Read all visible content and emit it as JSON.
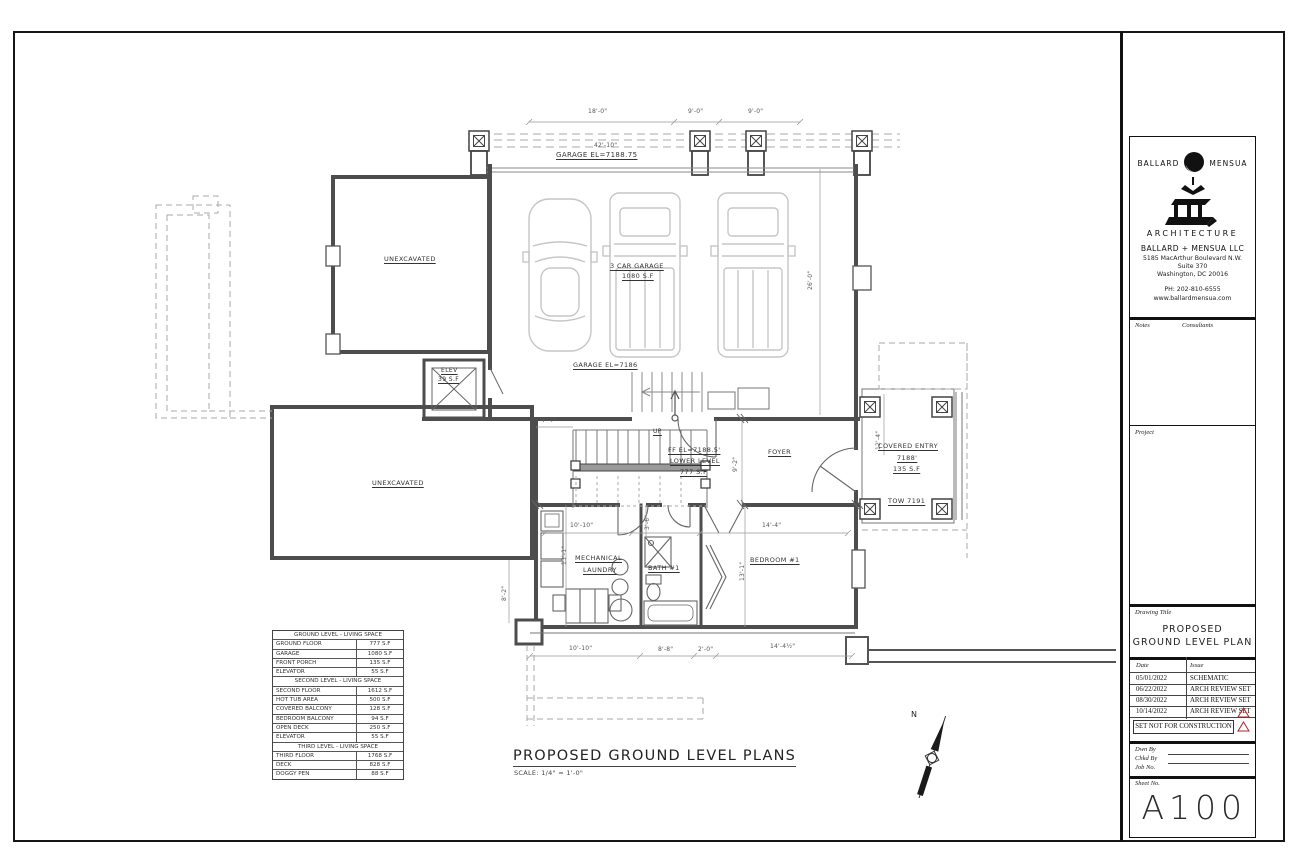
{
  "colors": {
    "wall_line": "#4d4d4d",
    "accent_red": "#b22222"
  },
  "title_block": {
    "logo_left": "BALLARD",
    "logo_right": "MENSUA",
    "logo_subtitle": "ARCHITECTURE",
    "firm_name": "BALLARD + MENSUA LLC",
    "address_line1": "5185 MacArthur Boulevard N.W.",
    "address_line2": "Suite 370",
    "address_line3": "Washington, DC 20016",
    "phone": "PH: 202-810-6555",
    "website": "www.ballardmensua.com",
    "notes_label": "Notes",
    "consultants_label": "Consultants",
    "project_label": "Project",
    "drawing_title_label": "Drawing Title",
    "drawing_title_line1": "PROPOSED",
    "drawing_title_line2": "GROUND LEVEL PLAN",
    "date_header": "Date",
    "issue_header": "Issue",
    "revisions": [
      {
        "date": "05/01/2022",
        "issue": "SCHEMATIC"
      },
      {
        "date": "06/22/2022",
        "issue": "ARCH REVIEW SET"
      },
      {
        "date": "08/30/2022",
        "issue": "ARCH REVIEW SET"
      },
      {
        "date": "10/14/2022",
        "issue": "ARCH REVIEW SET"
      }
    ],
    "not_for_construction": "SET NOT FOR CONSTRUCTION",
    "drawn_by_label": "Dwn By",
    "checked_by_label": "Chkd By",
    "job_no_label": "Job No.",
    "sheet_no_label": "Sheet No.",
    "sheet_number": "A100"
  },
  "area_table": {
    "sections": [
      {
        "header": "GROUND LEVEL - LIVING SPACE",
        "rows": [
          [
            "GROUND FLOOR",
            "777 S.F"
          ],
          [
            "GARAGE",
            "1080 S.F"
          ],
          [
            "FRONT PORCH",
            "135 S.F"
          ],
          [
            "ELEVATOR",
            "55 S.F"
          ]
        ]
      },
      {
        "header": "SECOND LEVEL - LIVING SPACE",
        "rows": [
          [
            "SECOND FLOOR",
            "1612 S.F"
          ],
          [
            "HOT TUB AREA",
            "500 S.F"
          ],
          [
            "COVERED BALCONY",
            "128 S.F"
          ],
          [
            "BEDROOM BALCONY",
            "94 S.F"
          ],
          [
            "OPEN DECK",
            "250 S.F"
          ],
          [
            "ELEVATOR",
            "55 S.F"
          ]
        ]
      },
      {
        "header": "THIRD LEVEL - LIVING SPACE",
        "rows": [
          [
            "THIRD FLOOR",
            "1768 S.F"
          ],
          [
            "DECK",
            "828 S.F"
          ],
          [
            "DOGGY PEN",
            "88 S.F"
          ]
        ]
      }
    ]
  },
  "plan": {
    "title": "PROPOSED GROUND LEVEL PLANS",
    "scale": "SCALE: 1/4\" = 1'-0\"",
    "north_label": "N",
    "labels": {
      "dim_18_0": "18'-0\"",
      "dim_9_0_a": "9'-0\"",
      "dim_9_0_b": "9'-0\"",
      "dim_42_10": "42'-10\"",
      "garage_el_upper": "GARAGE EL=7188.75",
      "unexcavated_upper": "UNEXCAVATED",
      "unexcavated_lower": "UNEXCAVATED",
      "garage_name": "3 CAR GARAGE",
      "garage_area": "1080 S.F",
      "garage_el_mid": "GARAGE EL=7186",
      "elev_name": "ELEV",
      "elev_area": "39 S.F",
      "up_label": "UP",
      "ff_el": "FF EL=7188.5'",
      "lower_level": "LOWER LEVEL",
      "lower_area": "777 S.F",
      "foyer": "FOYER",
      "covered_entry": "COVERED ENTRY",
      "entry_el": "7188'",
      "entry_area": "135 S.F",
      "tow": "TOW 7191",
      "mech_line1": "MECHANICAL",
      "mech_line2": "LAUNDRY",
      "bath": "BATH #1",
      "bedroom": "BEDROOM #1",
      "dim_10_10_top": "10'-10\"",
      "dim_14_4": "14'-4\"",
      "dim_10_10_bot": "10'-10\"",
      "dim_8_8": "8'-8\"",
      "dim_2_0": "2'-0\"",
      "dim_14_4_half": "14'-4½\"",
      "dim_8_2": "8'-2\"",
      "dim_9_2": "9'-2\"",
      "dim_12_4": "12'-4\"",
      "dim_13_1_a": "13'-1\"",
      "dim_13_1_b": "13'-1\"",
      "dim_26_0": "26'-0\"",
      "dim_3_6": "3'-6\"",
      "dim_4_4": "4'-4\""
    }
  }
}
